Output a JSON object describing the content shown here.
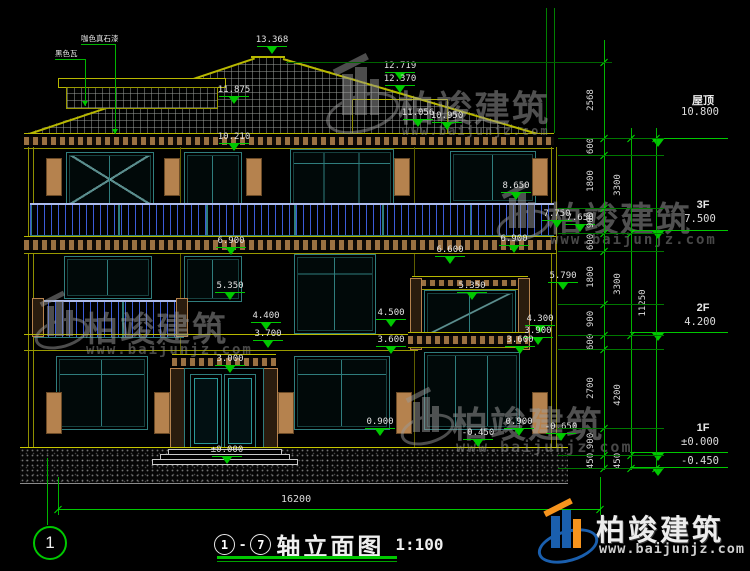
{
  "brand": {
    "name": "柏竣建筑",
    "url": "www.baijunjz.com"
  },
  "logo": {
    "name": "柏竣建筑",
    "url": "www.baijunjz.com"
  },
  "material_labels": [
    {
      "text": "咖色真石漆"
    },
    {
      "text": "黑色瓦"
    }
  ],
  "title_block": {
    "axis_start": "1",
    "axis_sep": "-",
    "axis_end": "7",
    "title": "轴立面图",
    "scale": "1:100",
    "sheet_bubble": "1"
  },
  "overall_dim": {
    "value": "16200"
  },
  "colors": {
    "dimension_green": "#00c800",
    "cad_yellow": "#b8b800",
    "window_teal": "#2f7d7d",
    "railing_blue": "#3c5cd8",
    "trim_tan": "#b5824e",
    "logo_blue": "#1a5fae",
    "logo_orange": "#f7941d"
  },
  "levels": [
    {
      "label": "屋顶",
      "value": "10.800",
      "y": 138,
      "ty": 92
    },
    {
      "label": "3F",
      "value": "7.500",
      "y": 230,
      "ty": 199
    },
    {
      "label": "2F",
      "value": "4.200",
      "y": 332,
      "ty": 302
    },
    {
      "label": "1F",
      "value": "±0.000",
      "y": 452,
      "ty": 422
    },
    {
      "label": "",
      "value": "-0.450",
      "y": 467,
      "ty": 456
    }
  ],
  "elevation_markers": [
    {
      "v": "13.368",
      "x": 272,
      "y": 35
    },
    {
      "v": "12.719",
      "x": 400,
      "y": 61
    },
    {
      "v": "12.370",
      "x": 400,
      "y": 74
    },
    {
      "v": "11.875",
      "x": 234,
      "y": 85
    },
    {
      "v": "11.056",
      "x": 418,
      "y": 108
    },
    {
      "v": "10.950",
      "x": 447,
      "y": 111
    },
    {
      "v": "10.210",
      "x": 234,
      "y": 132
    },
    {
      "v": "8.650",
      "x": 516,
      "y": 181
    },
    {
      "v": "7.750",
      "x": 557,
      "y": 209
    },
    {
      "v": "7.650",
      "x": 580,
      "y": 213
    },
    {
      "v": "6.900",
      "x": 231,
      "y": 236
    },
    {
      "v": "6.900",
      "x": 514,
      "y": 234
    },
    {
      "v": "6.600",
      "x": 450,
      "y": 245
    },
    {
      "v": "5.790",
      "x": 563,
      "y": 271
    },
    {
      "v": "5.350",
      "x": 230,
      "y": 281
    },
    {
      "v": "5.350",
      "x": 472,
      "y": 281
    },
    {
      "v": "4.400",
      "x": 266,
      "y": 311
    },
    {
      "v": "4.500",
      "x": 391,
      "y": 308
    },
    {
      "v": "4.300",
      "x": 540,
      "y": 314
    },
    {
      "v": "3.700",
      "x": 268,
      "y": 329
    },
    {
      "v": "3.600",
      "x": 391,
      "y": 335
    },
    {
      "v": "3.900",
      "x": 538,
      "y": 326
    },
    {
      "v": "3.600",
      "x": 520,
      "y": 335
    },
    {
      "v": "3.000",
      "x": 230,
      "y": 354
    },
    {
      "v": "0.900",
      "x": 380,
      "y": 417
    },
    {
      "v": "0.900",
      "x": 519,
      "y": 417
    },
    {
      "v": "-0.650",
      "x": 561,
      "y": 422
    },
    {
      "v": "-0.450",
      "x": 478,
      "y": 428
    },
    {
      "v": "±0.000",
      "x": 227,
      "y": 445
    }
  ],
  "dim_chains": [
    {
      "x": 604,
      "y_top": 40,
      "y_bottom": 470,
      "ticks": [
        62,
        138,
        155,
        208,
        233,
        251,
        304,
        335,
        349,
        428,
        455,
        468
      ],
      "labels": [
        {
          "t": "2568",
          "y": 100
        },
        {
          "t": "600",
          "y": 146
        },
        {
          "t": "1800",
          "y": 181
        },
        {
          "t": "900",
          "y": 220
        },
        {
          "t": "600",
          "y": 242
        },
        {
          "t": "1800",
          "y": 277
        },
        {
          "t": "900",
          "y": 319
        },
        {
          "t": "600",
          "y": 342
        },
        {
          "t": "2700",
          "y": 388
        },
        {
          "t": "900",
          "y": 441
        },
        {
          "t": "450",
          "y": 461
        }
      ]
    },
    {
      "x": 631,
      "y_top": 128,
      "y_bottom": 470,
      "ticks": [
        138,
        233,
        335,
        455,
        468
      ],
      "labels": [
        {
          "t": "3300",
          "y": 185
        },
        {
          "t": "3300",
          "y": 284
        },
        {
          "t": "4200",
          "y": 395
        },
        {
          "t": "450",
          "y": 461
        }
      ]
    },
    {
      "x": 656,
      "y_top": 128,
      "y_bottom": 470,
      "ticks": [
        138,
        468
      ],
      "labels": [
        {
          "t": "11250",
          "y": 303
        }
      ]
    }
  ],
  "connector_ys": [
    138,
    155,
    208,
    233,
    251,
    304,
    335,
    349,
    428,
    455,
    468
  ],
  "ridge_connector_y": 62
}
